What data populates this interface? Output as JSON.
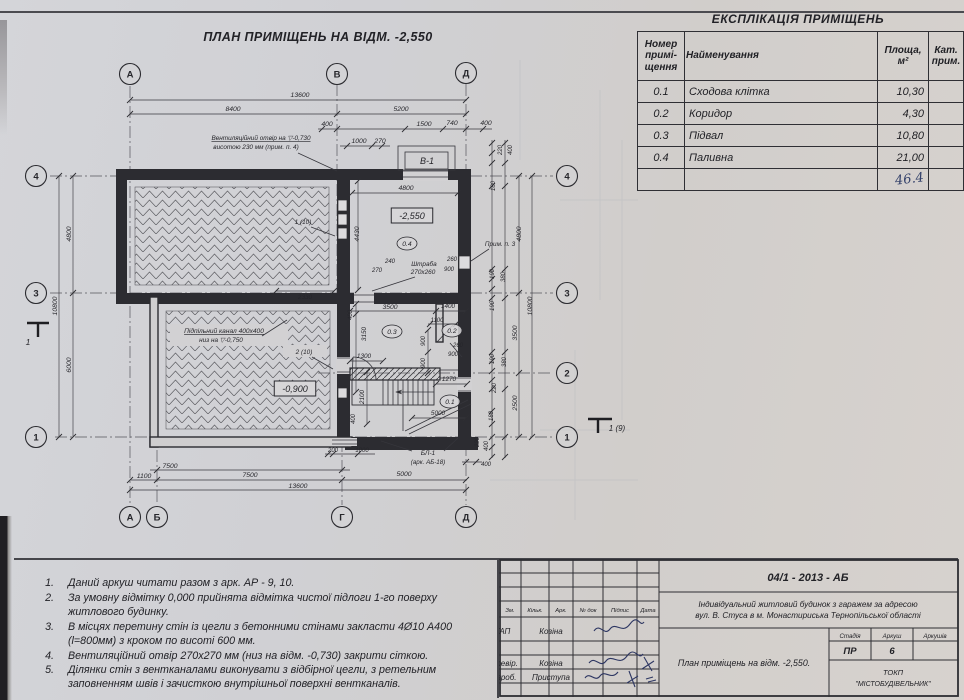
{
  "title": "ПЛАН ПРИМІЩЕНЬ НА ВІДМ. -2,550",
  "explication": {
    "title": "ЕКСПЛІКАЦІЯ ПРИМІЩЕНЬ",
    "headers": {
      "num": "Номер\nпримі-\nщення",
      "name": "Найменування",
      "area": "Площа,\nм²",
      "cat": "Кат.\nприм."
    },
    "rows": [
      [
        "0.1",
        "Сходова клітка",
        "10,30",
        ""
      ],
      [
        "0.2",
        "Коридор",
        "4,30",
        ""
      ],
      [
        "0.3",
        "Підвал",
        "10,80",
        ""
      ],
      [
        "0.4",
        "Паливна",
        "21,00",
        ""
      ]
    ],
    "total_handwritten": "46.4"
  },
  "notes": {
    "items": [
      {
        "n": "1.",
        "t": "Даний аркуш читати разом з арк. АР - 9, 10."
      },
      {
        "n": "2.",
        "t": "За умовну відмітку 0,000 прийнята відмітка чистої підлоги 1-го поверху житлового будинку."
      },
      {
        "n": "3.",
        "t": "В місцях перетину стін із цегли з бетонними стінами закласти 4Ø10 А400 (l=800мм) з кроком по висоті 600 мм."
      },
      {
        "n": "4.",
        "t": "Вентиляційний отвір 270x270 мм (низ на відм. -0,730) закрити сіткою."
      },
      {
        "n": "5.",
        "t": "Ділянки стін з вентканалами виконувати з відбірної цегли, з ретельним заповненням швів і зачисткою внутрішньої поверхні вентканалів."
      }
    ]
  },
  "titleblock": {
    "doc_code": "04/1 - 2013 - АБ",
    "project_l1": "Індивідуальний житловий будинок з гаражем за адресою",
    "project_l2": "вул. В. Стуса в м. Монастириська Тернопільської області",
    "cols": [
      "Зм.",
      "Кільк.",
      "Арк.",
      "№ док",
      "Підпис",
      "Дата"
    ],
    "roles": [
      {
        "role": "ГАП",
        "name": "Козіна"
      },
      {
        "role": "Перевір.",
        "name": "Козіна"
      },
      {
        "role": "Розроб.",
        "name": "Приступа"
      }
    ],
    "sheet_title": "План приміщень на відм. -2,550.",
    "stage_label": "Стадія",
    "sheet_label": "Аркуш",
    "sheets_label": "Аркушів",
    "stage": "ПР",
    "sheet_no": "6",
    "sheets": "",
    "org_l1": "ТОКП",
    "org_l2": "\"МІСТОБУДІВЕЛЬНИК\""
  },
  "plan": {
    "axes": [
      {
        "label": "А",
        "x": 130,
        "y": 74
      },
      {
        "label": "В",
        "x": 337,
        "y": 74
      },
      {
        "label": "Д",
        "x": 466,
        "y": 73
      },
      {
        "label": "А",
        "x": 130,
        "y": 517
      },
      {
        "label": "Б",
        "x": 157,
        "y": 517
      },
      {
        "label": "Г",
        "x": 342,
        "y": 517
      },
      {
        "label": "Д",
        "x": 466,
        "y": 517
      },
      {
        "label": "4",
        "x": 36,
        "y": 176
      },
      {
        "label": "3",
        "x": 36,
        "y": 293
      },
      {
        "label": "1",
        "x": 36,
        "y": 437
      },
      {
        "label": "4",
        "x": 567,
        "y": 176
      },
      {
        "label": "3",
        "x": 567,
        "y": 293
      },
      {
        "label": "2",
        "x": 567,
        "y": 373
      },
      {
        "label": "1",
        "x": 567,
        "y": 437
      }
    ],
    "labels": [
      {
        "t": "13600",
        "x": 300,
        "y": 97
      },
      {
        "t": "8400",
        "x": 233,
        "y": 111
      },
      {
        "t": "5200",
        "x": 401,
        "y": 111
      },
      {
        "t": "400",
        "x": 327,
        "y": 126
      },
      {
        "t": "1500",
        "x": 424,
        "y": 126
      },
      {
        "t": "740",
        "x": 452,
        "y": 125
      },
      {
        "t": "400",
        "x": 486,
        "y": 125
      },
      {
        "t": "1000",
        "x": 359,
        "y": 143
      },
      {
        "t": "270",
        "x": 380,
        "y": 143
      },
      {
        "t": "Вентиляційний отвір на ▽-0,730",
        "x": 261,
        "y": 140,
        "u": 1,
        "fs": 6.4
      },
      {
        "t": "висотою 230 мм (прим. п. 4)",
        "x": 256,
        "y": 149,
        "fs": 6.4
      },
      {
        "t": "В-1",
        "x": 427,
        "y": 164,
        "fs": 9
      },
      {
        "t": "220",
        "x": 502,
        "y": 150,
        "r": -90,
        "fs": 6
      },
      {
        "t": "400",
        "x": 512,
        "y": 150,
        "r": -90,
        "fs": 6
      },
      {
        "t": "180",
        "x": 495,
        "y": 186,
        "r": -90,
        "fs": 6
      },
      {
        "t": "4800",
        "x": 71,
        "y": 234,
        "r": -90
      },
      {
        "t": "10800",
        "x": 57,
        "y": 306,
        "r": -90
      },
      {
        "t": "6000",
        "x": 71,
        "y": 365,
        "r": -90
      },
      {
        "t": "1",
        "x": 28,
        "y": 345,
        "fs": 8.5
      },
      {
        "t": "4800",
        "x": 521,
        "y": 234,
        "r": -90
      },
      {
        "t": "Прим. п. 3",
        "x": 500,
        "y": 246,
        "fs": 6.4
      },
      {
        "t": "190",
        "x": 494,
        "y": 274,
        "r": -90,
        "fs": 6
      },
      {
        "t": "380",
        "x": 505,
        "y": 277,
        "r": -90,
        "fs": 6
      },
      {
        "t": "190",
        "x": 494,
        "y": 306,
        "r": -90,
        "fs": 6
      },
      {
        "t": "10800",
        "x": 532,
        "y": 306,
        "r": -90
      },
      {
        "t": "3500",
        "x": 517,
        "y": 333,
        "r": -90
      },
      {
        "t": "190",
        "x": 494,
        "y": 359,
        "r": -90,
        "fs": 6
      },
      {
        "t": "380",
        "x": 506,
        "y": 362,
        "r": -90,
        "fs": 6
      },
      {
        "t": "220",
        "x": 496,
        "y": 388,
        "r": -90,
        "fs": 6
      },
      {
        "t": "2500",
        "x": 517,
        "y": 403,
        "r": -90
      },
      {
        "t": "180",
        "x": 493,
        "y": 416,
        "r": -90,
        "fs": 6
      },
      {
        "t": "220",
        "x": 479,
        "y": 442,
        "r": -90,
        "fs": 6
      },
      {
        "t": "400",
        "x": 488,
        "y": 446,
        "r": -90,
        "fs": 6
      },
      {
        "t": "1 (9)",
        "x": 617,
        "y": 431,
        "fs": 8
      },
      {
        "t": "400",
        "x": 486,
        "y": 466,
        "fs": 6
      },
      {
        "t": "200",
        "x": 333,
        "y": 452,
        "fs": 6
      },
      {
        "t": "1000",
        "x": 362,
        "y": 452,
        "fs": 6
      },
      {
        "t": "БЛ-1",
        "x": 428,
        "y": 455,
        "fs": 6.6
      },
      {
        "t": "(арк. АБ-18)",
        "x": 428,
        "y": 464,
        "fs": 6.2
      },
      {
        "t": "7500",
        "x": 170,
        "y": 468
      },
      {
        "t": "1100",
        "x": 144,
        "y": 478
      },
      {
        "t": "7500",
        "x": 250,
        "y": 477
      },
      {
        "t": "5000",
        "x": 404,
        "y": 476
      },
      {
        "t": "13600",
        "x": 298,
        "y": 488
      },
      {
        "t": "1 (10)",
        "x": 303,
        "y": 224,
        "fs": 6.4
      },
      {
        "t": "4430",
        "x": 359,
        "y": 234,
        "r": -90
      },
      {
        "t": "4800",
        "x": 406,
        "y": 190
      },
      {
        "t": "-2,550",
        "x": 412,
        "y": 219,
        "box": 1,
        "fs": 9
      },
      {
        "t": "0.4",
        "x": 407,
        "y": 246,
        "circ": 1
      },
      {
        "t": "240",
        "x": 390,
        "y": 263,
        "fs": 6
      },
      {
        "t": "270",
        "x": 377,
        "y": 272,
        "fs": 6
      },
      {
        "t": "Штраба",
        "x": 424,
        "y": 266,
        "fs": 6.4
      },
      {
        "t": "270x260",
        "x": 423,
        "y": 274,
        "fs": 6.4
      },
      {
        "t": "260",
        "x": 452,
        "y": 261,
        "fs": 6
      },
      {
        "t": "900",
        "x": 449,
        "y": 271,
        "fs": 6
      },
      {
        "t": "2330",
        "x": 305,
        "y": 299,
        "fs": 6.4
      },
      {
        "t": "3500",
        "x": 390,
        "y": 309
      },
      {
        "t": "1400",
        "x": 448,
        "y": 308,
        "fs": 6.4
      },
      {
        "t": "400",
        "x": 352,
        "y": 315,
        "r": -90,
        "fs": 6
      },
      {
        "t": "3150",
        "x": 366,
        "y": 334,
        "r": -90,
        "fs": 6.4
      },
      {
        "t": "1100",
        "x": 437,
        "y": 322,
        "fs": 6
      },
      {
        "t": "0.3",
        "x": 392,
        "y": 334,
        "circ": 1
      },
      {
        "t": "0.2",
        "x": 452,
        "y": 333,
        "circ": 1
      },
      {
        "t": "900",
        "x": 425,
        "y": 341,
        "r": -90,
        "fs": 6
      },
      {
        "t": "900",
        "x": 425,
        "y": 363,
        "r": -90,
        "fs": 6
      },
      {
        "t": "260",
        "x": 458,
        "y": 347,
        "fs": 6
      },
      {
        "t": "900",
        "x": 453,
        "y": 356,
        "fs": 6
      },
      {
        "t": "Підпільний канал 400x400",
        "x": 224,
        "y": 333,
        "u": 1,
        "fs": 6.6
      },
      {
        "t": "низ на ▽-0,750",
        "x": 221,
        "y": 342,
        "fs": 6.4
      },
      {
        "t": "2 (10)",
        "x": 304,
        "y": 354,
        "fs": 6.4
      },
      {
        "t": "-0,900",
        "x": 295,
        "y": 392,
        "box": 1,
        "fs": 9
      },
      {
        "t": "1300",
        "x": 364,
        "y": 358,
        "fs": 6.4
      },
      {
        "t": "2100",
        "x": 364,
        "y": 397,
        "r": -90,
        "fs": 6.4
      },
      {
        "t": "1270",
        "x": 449,
        "y": 381,
        "fs": 6.4
      },
      {
        "t": "0.1",
        "x": 450,
        "y": 404,
        "circ": 1
      },
      {
        "t": "5000",
        "x": 438,
        "y": 415,
        "fs": 6.4
      },
      {
        "t": "400",
        "x": 355,
        "y": 419,
        "r": -90,
        "fs": 6
      }
    ]
  }
}
